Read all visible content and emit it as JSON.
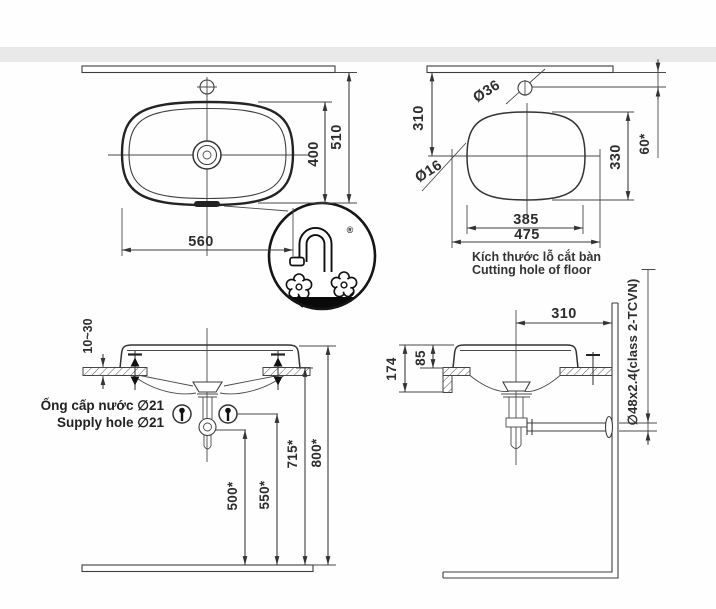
{
  "labels": {
    "top_view": {
      "width": "560",
      "depth": "400",
      "wall_offset": "510"
    },
    "cutting_hole": {
      "wall_to_center": "310",
      "faucet_hole_dia": "Ø36",
      "side_hole_dia": "Ø16",
      "depth": "330",
      "faucet_offset": "60*",
      "inner_width": "385",
      "outer_width": "475",
      "caption_vi": "Kích thước lỗ cắt bàn",
      "caption_en": "Cutting hole of floor"
    },
    "front_view": {
      "counter_thickness": "10~30",
      "supply_label_vi": "Ống cấp nước ∅21",
      "supply_label_en": "Supply hole ∅21",
      "drain_height": "500*",
      "supply_height": "550*",
      "counter_height": "715*",
      "rim_height": "800*"
    },
    "side_view": {
      "center_to_wall": "310",
      "rim_above_counter": "85",
      "rim_to_counter_bottom": "174",
      "drain_pipe_spec": "∅48x2.4(class 2-TCVN)"
    },
    "logo": {
      "registered_mark": "®"
    }
  },
  "colors": {
    "line": "#3e3e3e",
    "ink": "#111111",
    "band": "#e3e3e3",
    "background": "#ffffff"
  }
}
